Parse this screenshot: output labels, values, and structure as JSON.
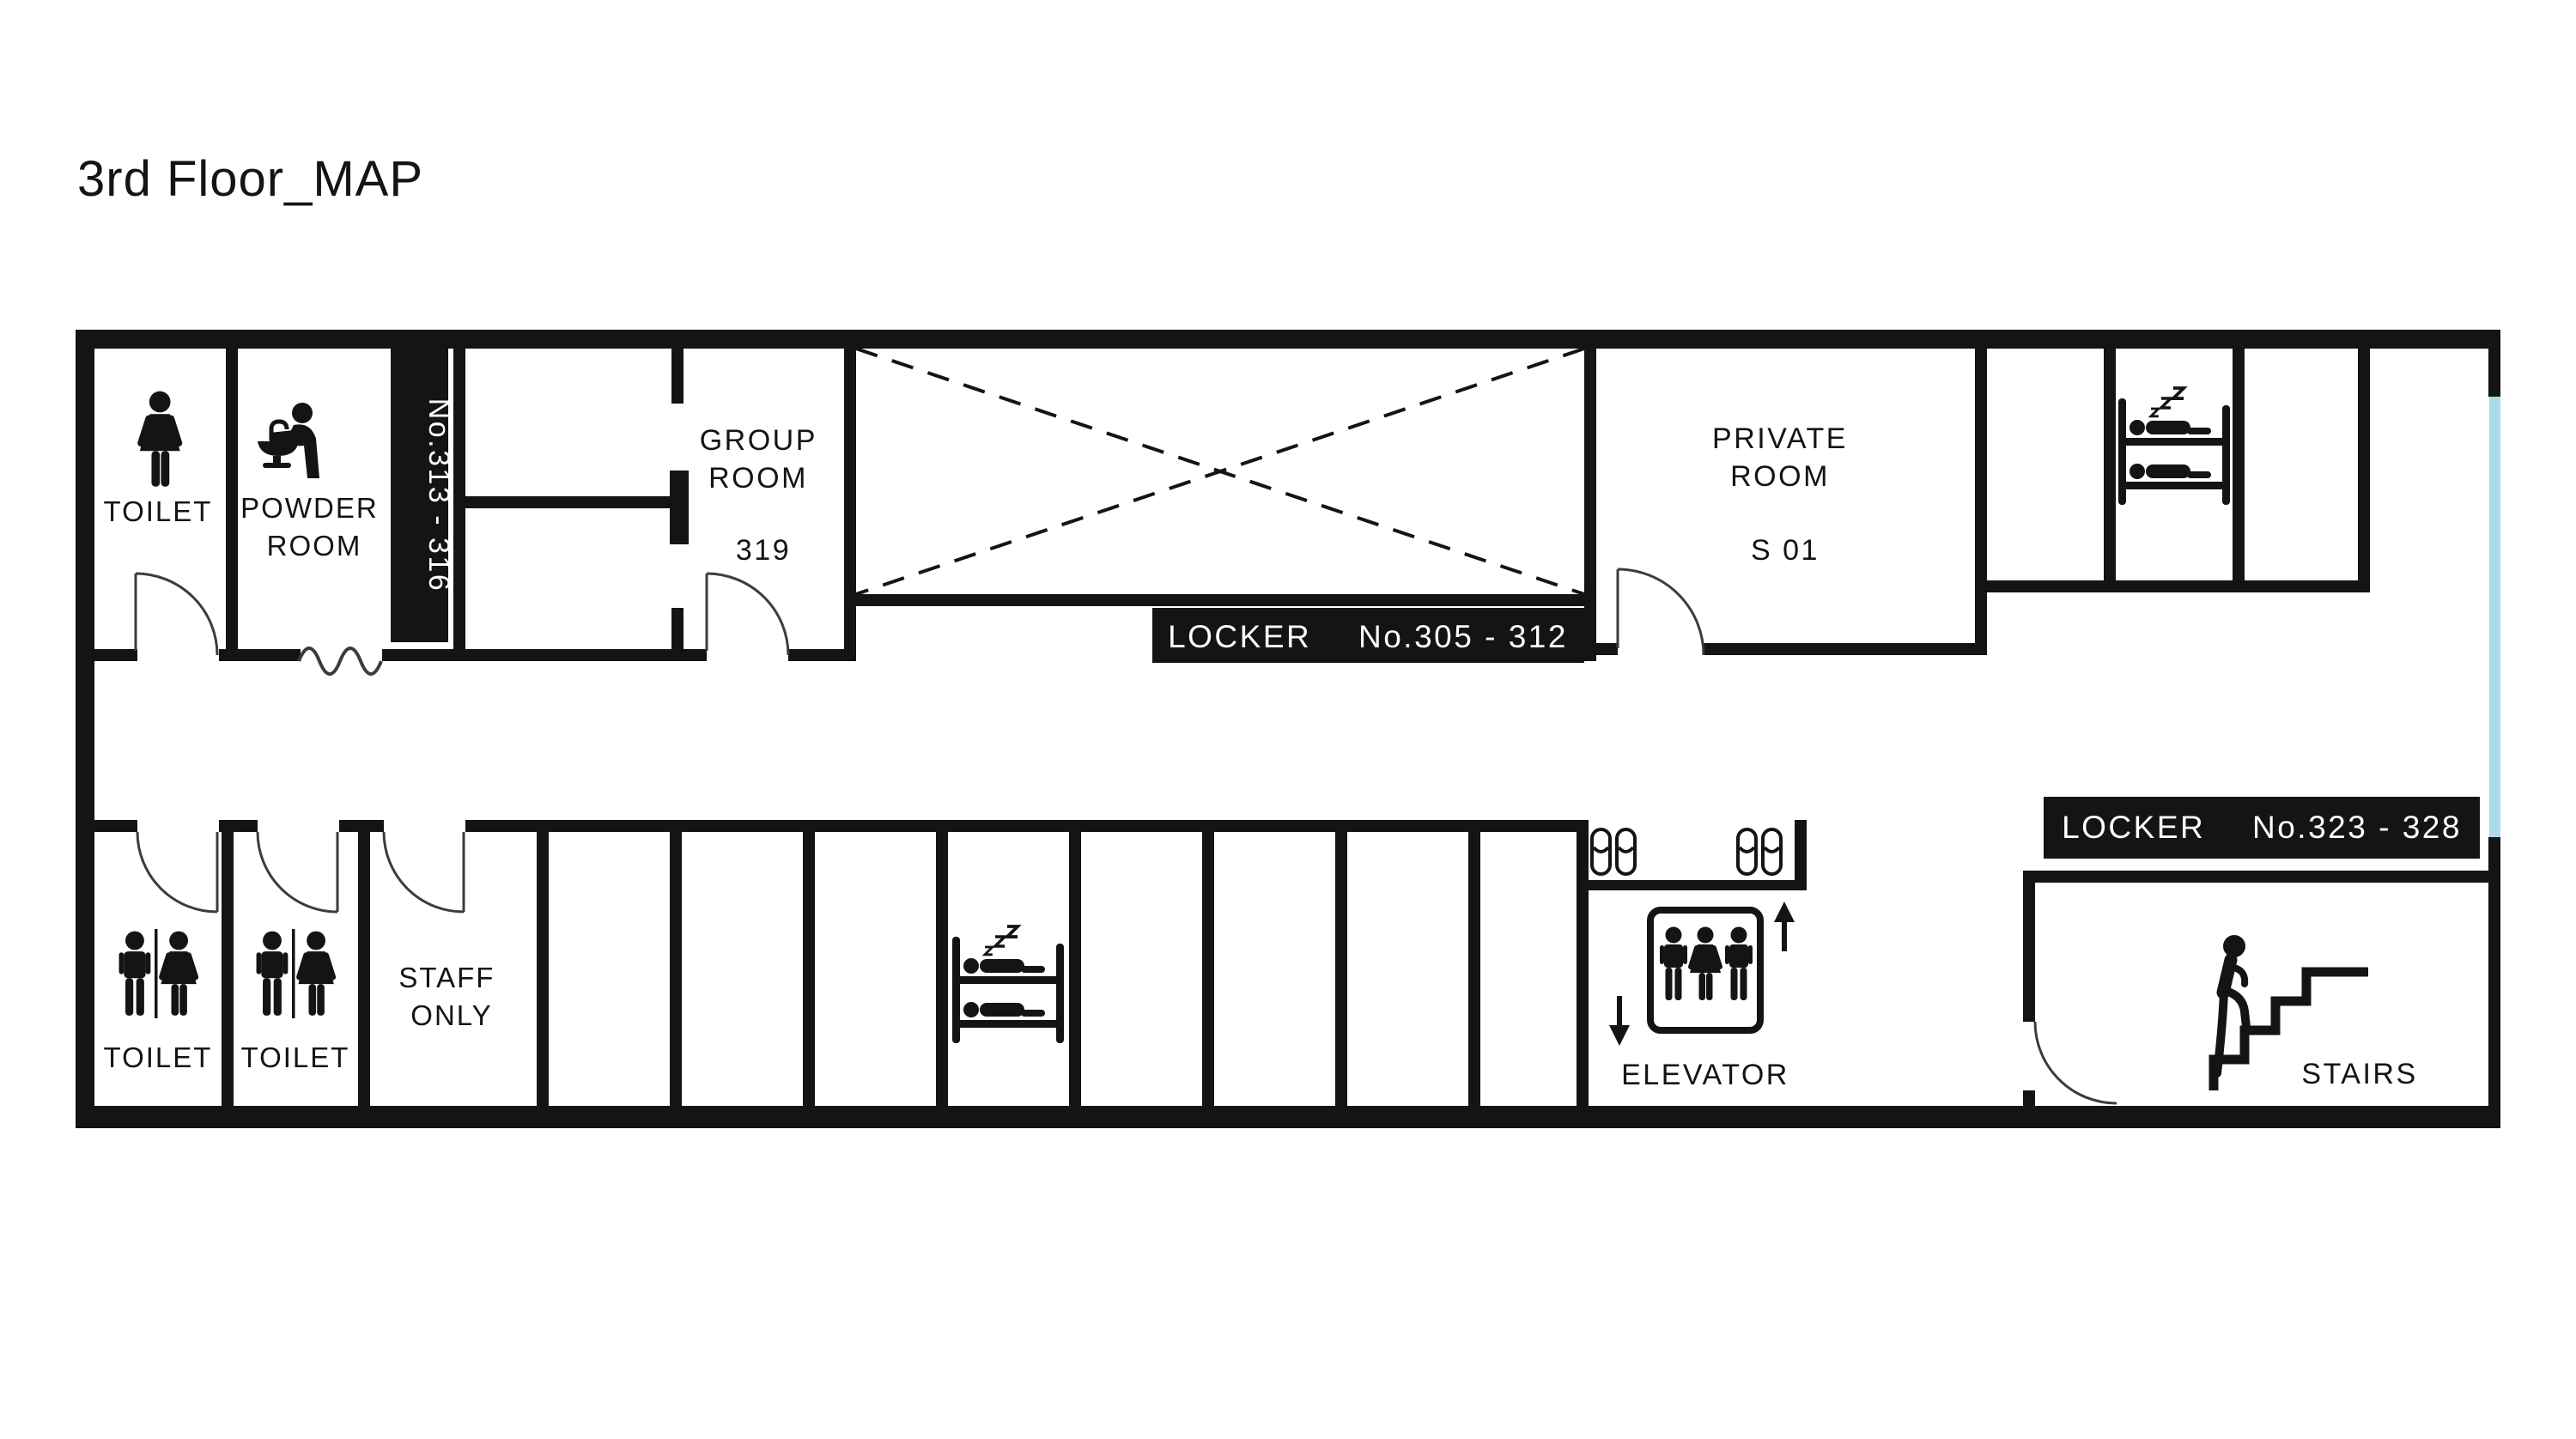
{
  "title": "3rd Floor_MAP",
  "colors": {
    "wall": "#141414",
    "door": "#3c3c3c",
    "window": "#a9dce6",
    "label_bg": "#141414",
    "label_fg": "#ffffff"
  },
  "rooms": {
    "toilet_top": {
      "label": "TOILET"
    },
    "powder_room": {
      "line1": "POWDER",
      "line2": "ROOM"
    },
    "group_room": {
      "line1": "GROUP",
      "line2": "ROOM",
      "number": "319"
    },
    "private_room": {
      "line1": "PRIVATE",
      "line2": "ROOM",
      "number": "S 01"
    },
    "toilet_bottom_left": {
      "label": "TOILET"
    },
    "toilet_bottom_right": {
      "label": "TOILET"
    },
    "staff_only": {
      "line1": "STAFF",
      "line2": "ONLY"
    },
    "elevator": {
      "label": "ELEVATOR"
    },
    "stairs": {
      "label": "STAIRS"
    }
  },
  "lockers": {
    "bank_313_316": {
      "label": "No.313 - 316"
    },
    "bank_305_312": {
      "prefix": "LOCKER",
      "range": "No.305 - 312"
    },
    "bank_323_328": {
      "prefix": "LOCKER",
      "range": "No.323 - 328"
    }
  }
}
